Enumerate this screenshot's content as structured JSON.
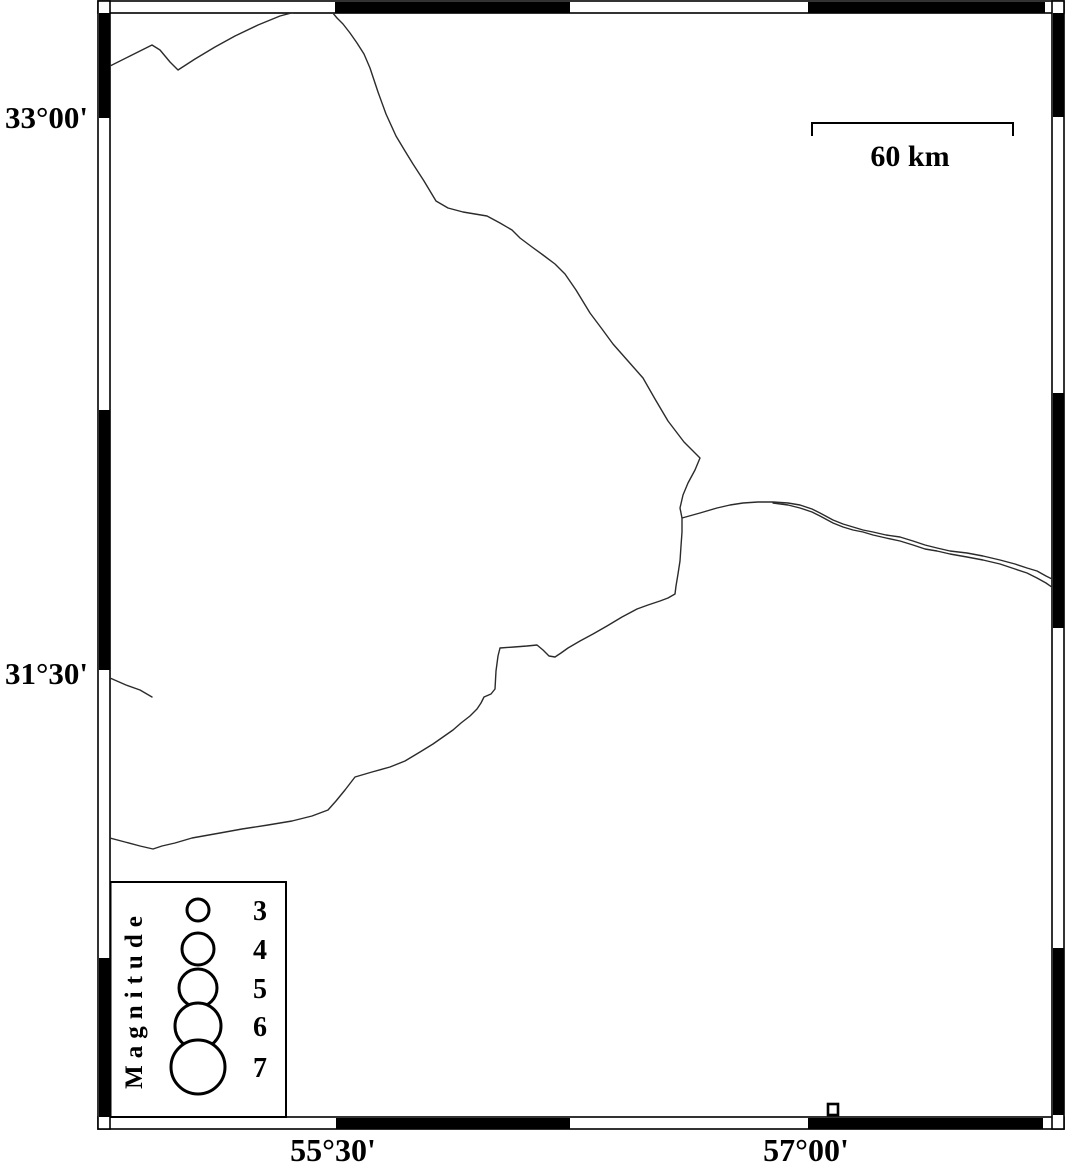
{
  "map": {
    "colors": {
      "background": "#ffffff",
      "frame": "#000000",
      "coastline": "#2b2b2b"
    },
    "axis": {
      "lat_labels": [
        "33°00'",
        "31°30'"
      ],
      "lon_labels": [
        "55°30'",
        "57°00'"
      ]
    },
    "scale_bar": {
      "label": "60 km"
    },
    "legend": {
      "title": "Magnitude",
      "entries": [
        {
          "label": "3",
          "radius": 11
        },
        {
          "label": "4",
          "radius": 16
        },
        {
          "label": "5",
          "radius": 19
        },
        {
          "label": "6",
          "radius": 23
        },
        {
          "label": "7",
          "radius": 27
        }
      ]
    }
  }
}
